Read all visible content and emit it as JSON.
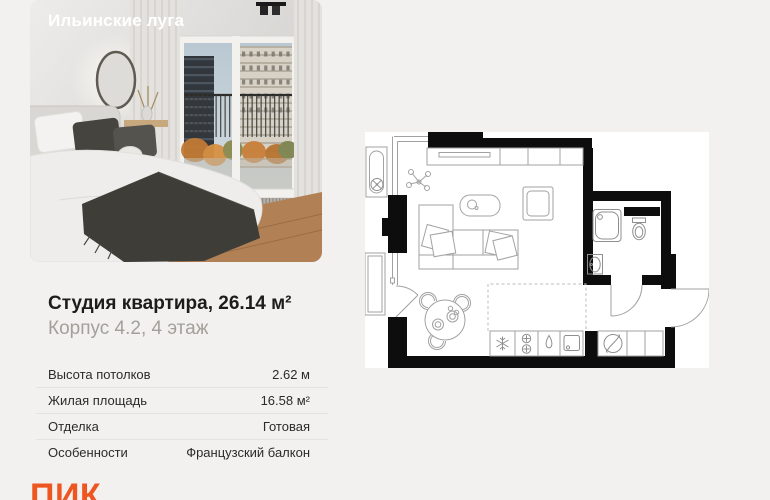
{
  "page": {
    "background": "#f2f1ef",
    "accent": "#ee5621",
    "divider_color": "#e5e3e0"
  },
  "card": {
    "project_name": "Ильинские луга",
    "title": "Студия квартира, 26.14 м²",
    "subtitle": "Корпус 4.2, 4 этаж",
    "specs": [
      {
        "label": "Высота потолков",
        "value": "2.62 м"
      },
      {
        "label": "Жилая площадь",
        "value": "16.58 м²"
      },
      {
        "label": "Отделка",
        "value": "Готовая"
      },
      {
        "label": "Особенности",
        "value": "Французский балкон"
      }
    ],
    "logo_text": "ПИК"
  },
  "floor_plan": {
    "type": "studio-apartment-plan",
    "background": "#ffffff",
    "wall_color": "#0d0d0d",
    "line_color": "#a2a2a2",
    "icons": [
      "radiator-fan-icon",
      "wardrobe",
      "plant-icon",
      "coffee-table",
      "armchair",
      "sofa",
      "dining-table",
      "chair-icon",
      "fridge-snowflake-icon",
      "stove-burners-icon",
      "water-drop-icon",
      "kitchen-sink-icon",
      "electrical-panel-icon",
      "shower",
      "toilet-icon",
      "washbasin-icon",
      "balcony-door",
      "bathroom-door",
      "entrance-door"
    ]
  }
}
